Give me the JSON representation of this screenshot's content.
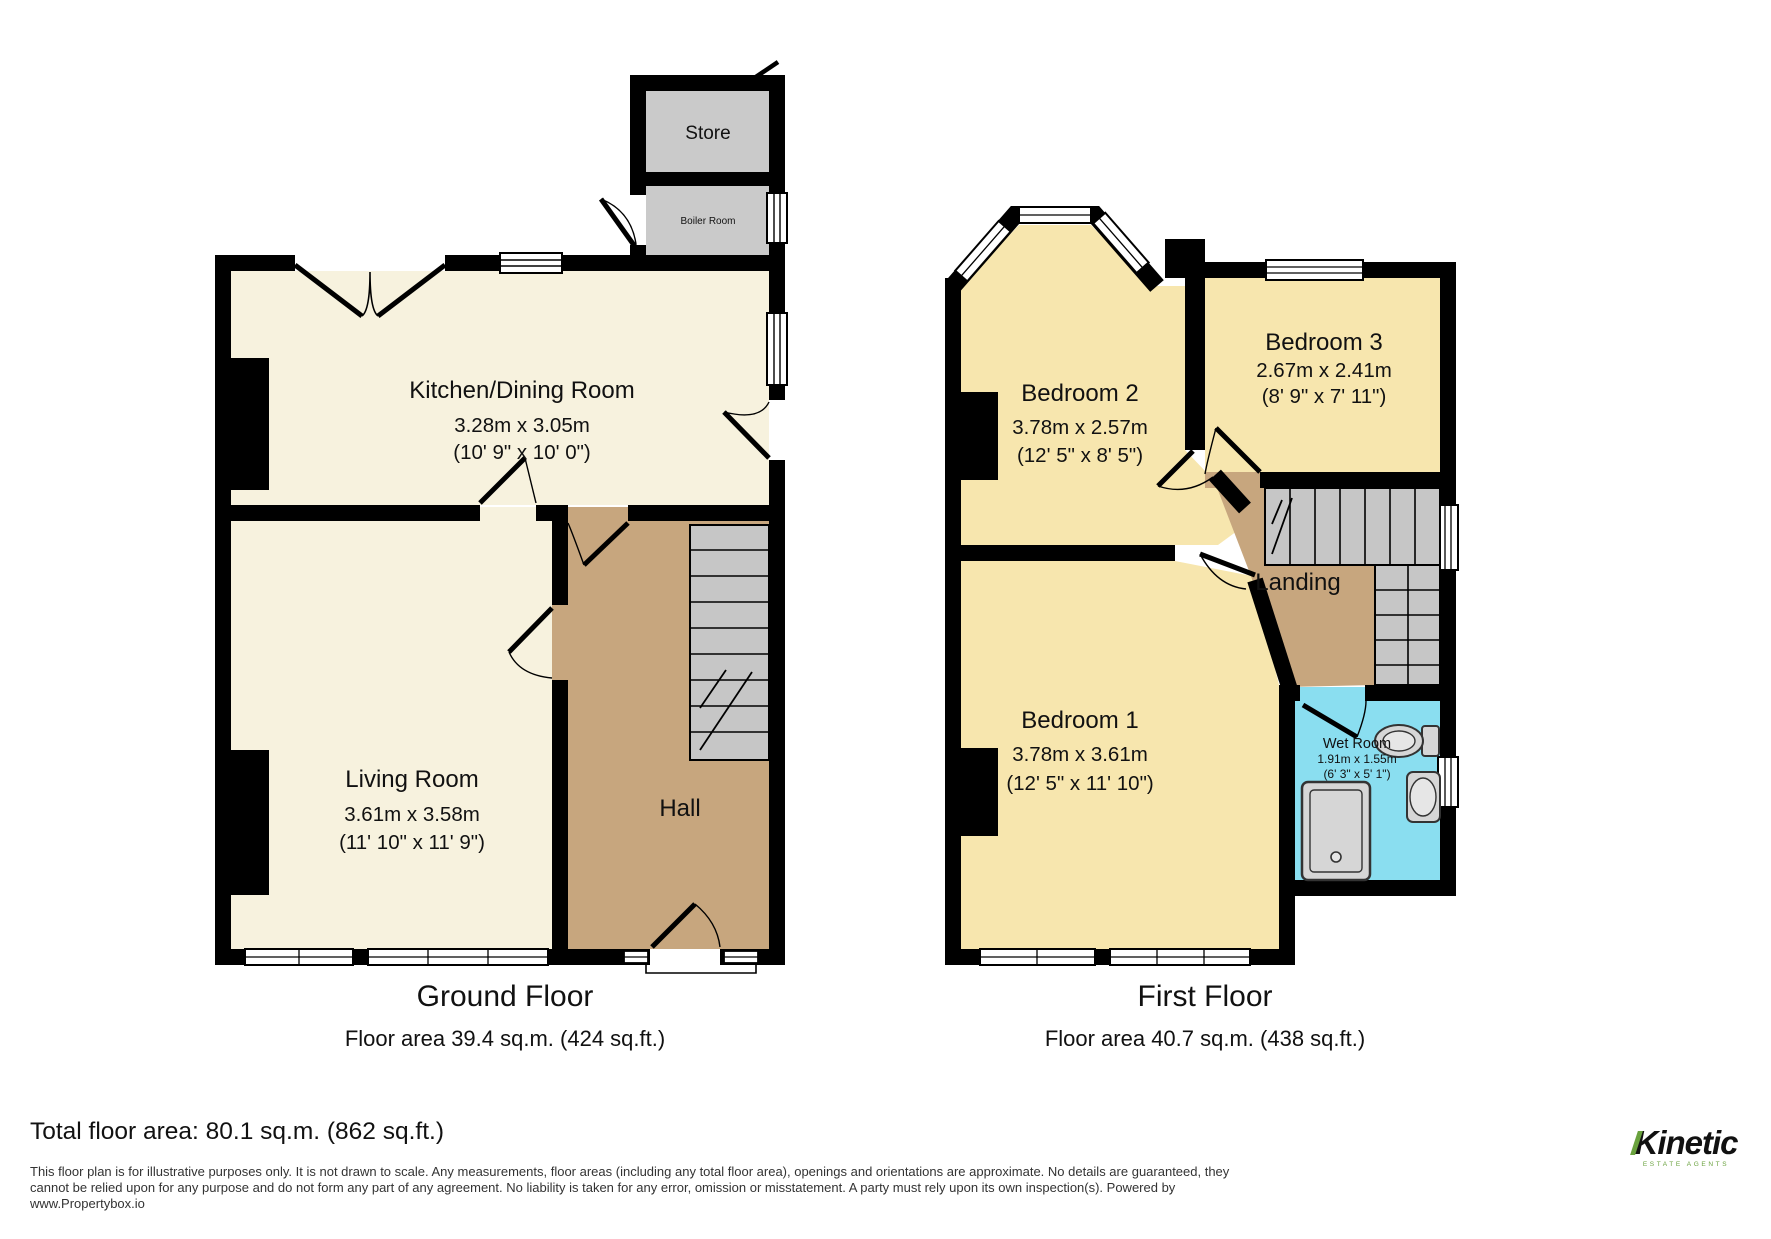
{
  "ground_floor": {
    "title": "Ground Floor",
    "area": "Floor area 39.4 sq.m. (424 sq.ft.)",
    "rooms": {
      "store": {
        "name": "Store"
      },
      "boiler": {
        "name": "Boiler Room"
      },
      "kitchen": {
        "name": "Kitchen/Dining Room",
        "metric": "3.28m x 3.05m",
        "imperial": "(10' 9\" x 10' 0\")"
      },
      "living": {
        "name": "Living Room",
        "metric": "3.61m x 3.58m",
        "imperial": "(11' 10\" x 11' 9\")"
      },
      "hall": {
        "name": "Hall"
      }
    }
  },
  "first_floor": {
    "title": "First Floor",
    "area": "Floor area 40.7 sq.m. (438 sq.ft.)",
    "rooms": {
      "bedroom2": {
        "name": "Bedroom 2",
        "metric": "3.78m x 2.57m",
        "imperial": "(12' 5\" x 8' 5\")"
      },
      "bedroom3": {
        "name": "Bedroom 3",
        "metric": "2.67m x 2.41m",
        "imperial": "(8' 9\" x 7' 11\")"
      },
      "landing": {
        "name": "Landing"
      },
      "bedroom1": {
        "name": "Bedroom 1",
        "metric": "3.78m x 3.61m",
        "imperial": "(12' 5\" x 11' 10\")"
      },
      "wetroom": {
        "name": "Wet Room",
        "metric": "1.91m x 1.55m",
        "imperial": "(6' 3\" x 5' 1\")"
      }
    }
  },
  "footer": {
    "total": "Total floor area: 80.1 sq.m. (862 sq.ft.)",
    "disclaimer_line1": "This floor plan is for illustrative purposes only. It is not drawn to scale. Any measurements, floor areas (including any total floor area), openings and orientations are approximate. No details are guaranteed, they",
    "disclaimer_line2": "cannot be relied upon for any purpose and do not form any part of any agreement. No liability is taken for any error, omission or misstatement. A party must rely upon its own inspection(s). Powered by",
    "disclaimer_line3": "www.Propertybox.io",
    "logo_text": "Kinetic",
    "logo_sub": "ESTATE AGENTS"
  },
  "colors": {
    "wall": "#000000",
    "ground_room_fill": "#f7f2de",
    "bedroom_fill": "#f7e6ae",
    "hall_fill": "#c7a67e",
    "stairs_fill": "#c6c6c6",
    "store_fill": "#cacaca",
    "wetroom_fill": "#8adef0",
    "logo_green": "#6aa23e"
  }
}
